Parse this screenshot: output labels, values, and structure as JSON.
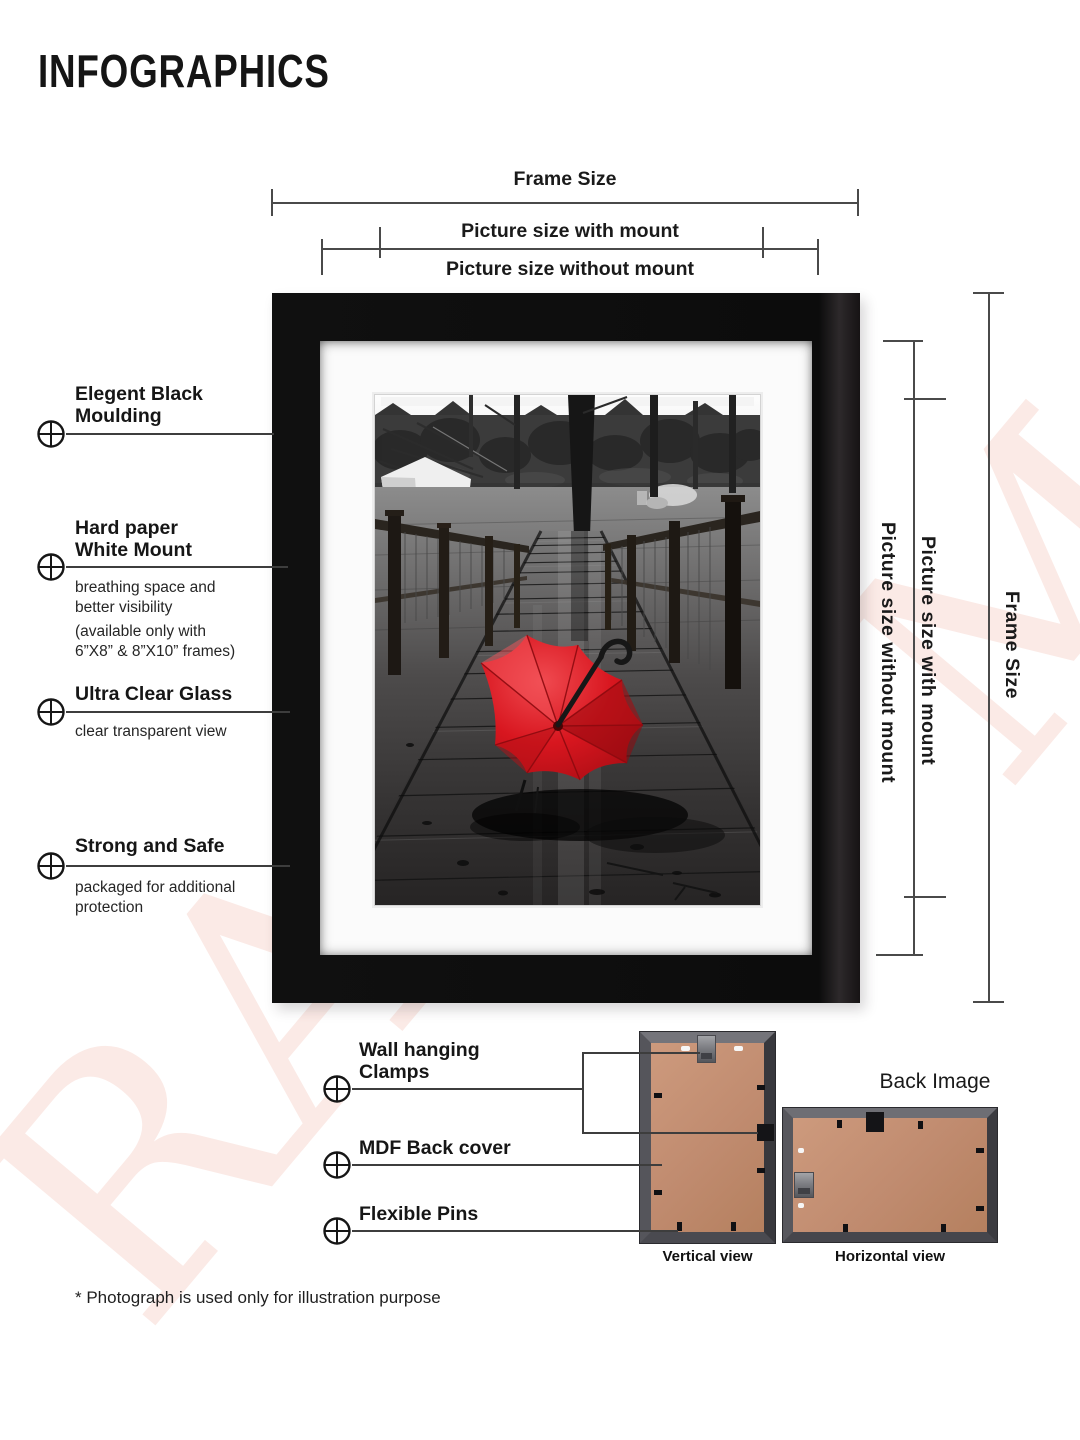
{
  "page": {
    "title": "INFOGRAPHICS",
    "footnote": "* Photograph is used only for illustration purpose",
    "watermark_letters": {
      "bottom_left": "RA",
      "top_right": "M"
    },
    "watermark_color": "#fbeae6"
  },
  "dimensions": {
    "top": {
      "frame_size": "Frame Size",
      "with_mount": "Picture size with mount",
      "without_mount": "Picture size without mount"
    },
    "right": {
      "without_mount": "Picture size without mount",
      "with_mount": "Picture size with mount",
      "frame_size": "Frame Size"
    }
  },
  "features": [
    {
      "title": "Elegent Black\nMoulding",
      "details": []
    },
    {
      "title": "Hard paper\nWhite Mount",
      "details": [
        "breathing space and\nbetter visibility",
        "(available only with\n6”X8” & 8”X10” frames)"
      ]
    },
    {
      "title": "Ultra Clear Glass",
      "details": [
        "clear transparent view"
      ]
    },
    {
      "title": "Strong and Safe",
      "details": [
        "packaged for additional\nprotection"
      ]
    }
  ],
  "back_features": [
    {
      "title": "Wall hanging\nClamps"
    },
    {
      "title": "MDF Back cover"
    },
    {
      "title": "Flexible Pins"
    }
  ],
  "back_section": {
    "heading": "Back Image",
    "vertical_label": "Vertical view",
    "horizontal_label": "Horizontal view"
  },
  "frame_product": {
    "moulding_color": "#0d0d0d",
    "mount_color": "#fbfbfb",
    "mdf_color": "#c08b6f",
    "umbrella_color": "#d8161f"
  }
}
